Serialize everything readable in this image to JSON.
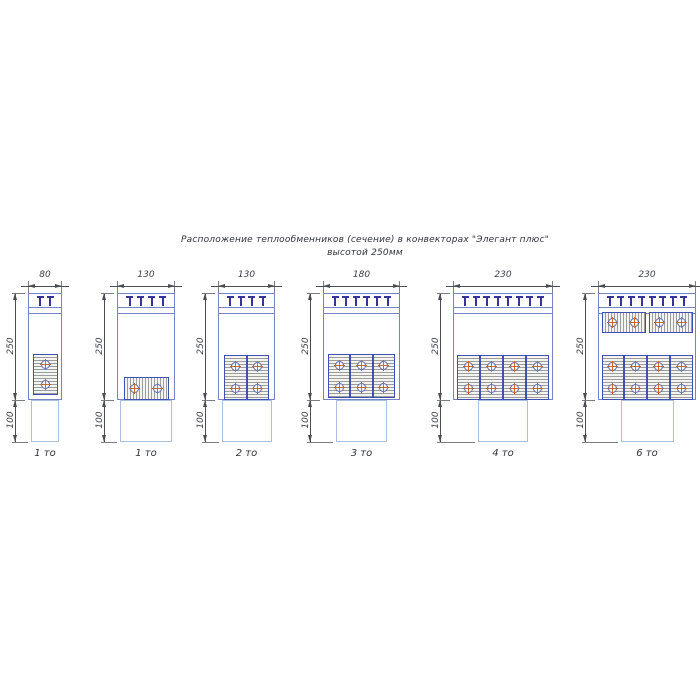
{
  "title": {
    "line1": "Расположение теплообменников (сечение) в конвекторах \"Элегант плюс\"",
    "line2": "высотой 250мм"
  },
  "units": "mm",
  "colors": {
    "outline_blue": "#7484c4",
    "pale_blue": "#a9c0de",
    "grille_navy": "#33339b",
    "exchanger_border_navy": "#4050b0",
    "hatch_gray": "#9c9c9c",
    "tube_ring_blue": "#5c63ad",
    "tube_cross_orange": "#c06a38",
    "dimension_dark": "#3a3d44",
    "background": "#ffffff"
  },
  "figures": [
    {
      "width": "80",
      "height": "250",
      "depth": "100",
      "caption": "1 то",
      "tmarks": 2,
      "exchangers": [
        {
          "rows": 2,
          "cols": 1,
          "hatch": "horizontal",
          "groups": 1
        }
      ]
    },
    {
      "width": "130",
      "height": "250",
      "depth": "100",
      "caption": "1 то",
      "tmarks": 4,
      "exchangers": [
        {
          "rows": 1,
          "cols": 2,
          "hatch": "vertical",
          "groups": 1
        }
      ]
    },
    {
      "width": "130",
      "height": "250",
      "depth": "100",
      "caption": "2 то",
      "tmarks": 4,
      "exchangers": [
        {
          "rows": 2,
          "cols": 2,
          "hatch": "horizontal",
          "groups": 1
        }
      ]
    },
    {
      "width": "180",
      "height": "250",
      "depth": "100",
      "caption": "3 то",
      "tmarks": 6,
      "exchangers": [
        {
          "rows": 2,
          "cols": 3,
          "hatch": "horizontal",
          "groups": 1
        }
      ]
    },
    {
      "width": "230",
      "height": "250",
      "depth": "100",
      "caption": "4 то",
      "tmarks": 8,
      "exchangers": [
        {
          "rows": 2,
          "cols": 4,
          "hatch": "horizontal",
          "groups": 1
        }
      ]
    },
    {
      "width": "230",
      "height": "250",
      "depth": "100",
      "caption": "6 то",
      "tmarks": 8,
      "exchangers": [
        {
          "rows": 1,
          "cols": 4,
          "hatch": "vertical",
          "groups": 2
        },
        {
          "rows": 2,
          "cols": 4,
          "hatch": "horizontal",
          "groups": 1
        }
      ]
    }
  ]
}
